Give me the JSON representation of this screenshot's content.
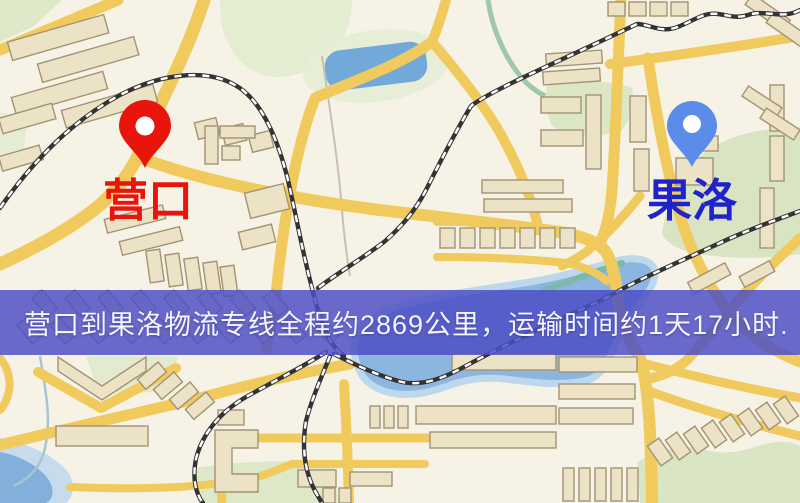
{
  "map": {
    "type": "road-map",
    "colors": {
      "background": "#f7f2e6",
      "road": "#f0ca5c",
      "park": "#dce7c6",
      "water": "#8cb6e0",
      "railway": "#333333",
      "building": "#ece2c6"
    }
  },
  "route": {
    "origin": {
      "name": "营口",
      "pin_color": "#e8150d",
      "label_color": "#e8150d"
    },
    "destination": {
      "name": "果洛",
      "pin_color": "#5a8ce8",
      "label_color": "#2022cc"
    }
  },
  "banner": {
    "text": "营口到果洛物流专线全程约2869公里，运输时间约1天17小时.",
    "background_color": "#4c4fc5",
    "text_color": "#f5f4ff",
    "distance_km": "2869",
    "duration": "1天17小时"
  }
}
